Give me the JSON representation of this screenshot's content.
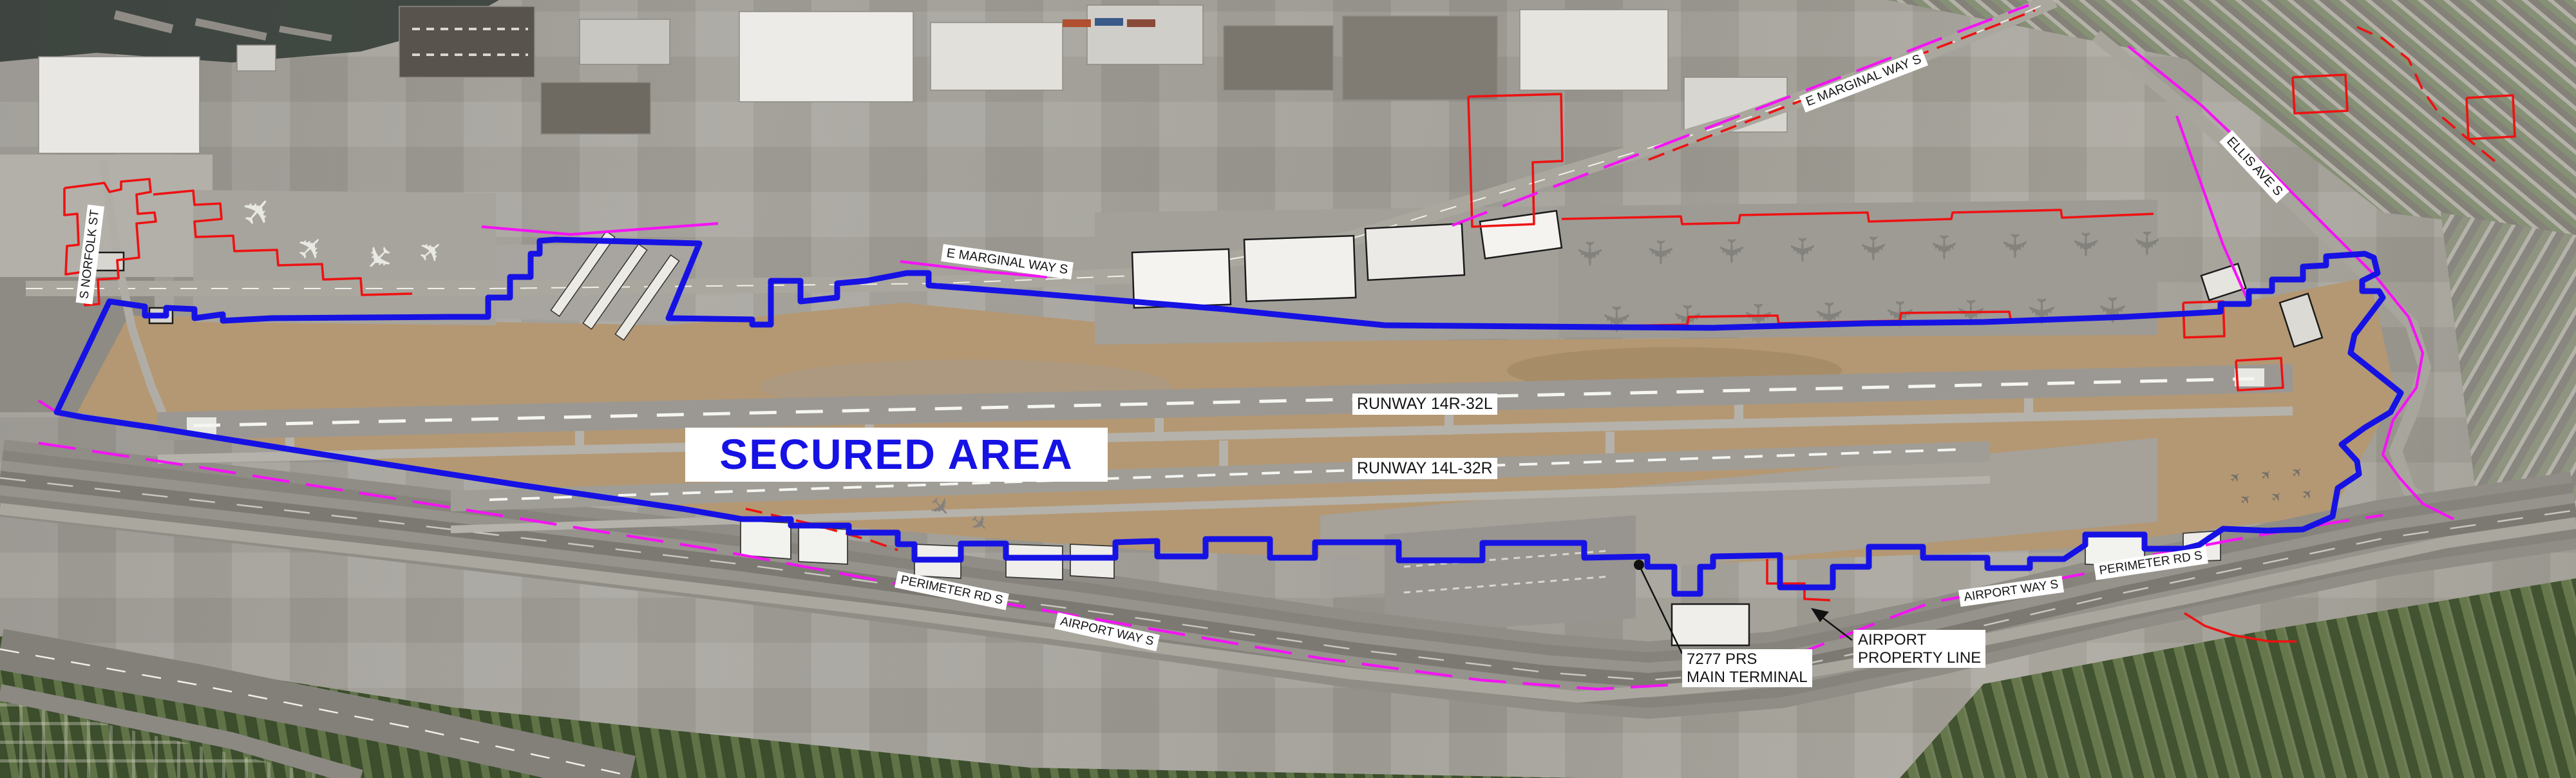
{
  "labels": {
    "secured_area": "SECURED AREA",
    "runway_14r": "RUNWAY 14R-32L",
    "runway_14l": "RUNWAY 14L-32R",
    "e_marginal_west": "E MARGINAL WAY S",
    "e_marginal_east": "E MARGINAL WAY S",
    "ellis_ave": "ELLIS AVE S",
    "s_norfolk": "S NORFOLK ST",
    "perimeter_rd_west": "PERIMETER RD S",
    "airport_way_west": "AIRPORT WAY S",
    "airport_way_east": "AIRPORT WAY S",
    "perimeter_rd_east": "PERIMETER RD S"
  },
  "callouts": {
    "terminal": {
      "line1": "7277 PRS",
      "line2": "MAIN TERMINAL"
    },
    "property": {
      "line1": "AIRPORT",
      "line2": "PROPERTY LINE"
    }
  },
  "colors": {
    "secured_boundary": "#1612e4",
    "secured_text": "#1612e4",
    "lease_lines_red": "#ee1212",
    "property_line_magenta": "#f513f5",
    "label_text": "#151515",
    "label_background": "#ffffff"
  },
  "icons": {
    "airplane": "✈"
  },
  "overlays": {
    "secured_boundary": "88,640 170,468 225,476 225,490 258,490 258,478 302,480 302,494 346,488 346,498 422,494 700,492 758,492 758,462 792,462 792,430 824,430 824,394 838,394 838,374 862,372 1086,378 1038,494 1168,496 1168,504 1197,504 1197,436 1243,436 1243,468 1300,462 1300,440 1345,436 1408,424 1442,424 1442,443 1600,455 1900,480 2150,505 2500,508 2660,509 2900,502 3080,500 3300,492 3448,484 3448,472 3492,472 3492,452 3528,452 3528,434 3576,434 3576,414 3612,412 3612,398 3672,394 3686,400 3692,424 3668,436 3668,452 3694,452 3700,462 3656,520 3650,548 3728,610 3712,640 3672,664 3636,690 3660,716 3663,736 3630,758 3622,802 3576,822 3520,824 3452,821 3415,846 3392,852 3330,852 3330,830 3238,830 3238,846 3205,868 3152,868 3152,882 3086,882 3086,866 2986,866 2986,849 2902,849 2902,880 2846,880 2846,912 2764,912 2764,862 2660,864 2660,880 2640,880 2640,922 2600,922 2600,880 2558,880 2558,864 2460,866 2460,843 2302,843 2302,870 2172,870 2172,842 2042,842 2042,866 1972,866 1972,837 1872,837 1872,864 1797,864 1797,840 1732,842 1732,866 1562,866 1562,844 1492,844 1492,869 1420,869 1420,845 1394,845 1394,827 1318,827 1318,816 1228,816 1228,806 1152,806 1060,790 800,752 452,698 240,664 130,648 88,640",
    "red_lines": [
      "100,292 162,284 170,298 188,294 188,282 232,278 234,298 212,302 214,332 240,330 242,344 212,347 216,400 182,404 184,432 152,434 154,472 132,474 130,422 102,426 104,382 122,380 120,332 100,334 100,292",
      "238,302 300,296 302,318 342,316 344,340 302,344 304,368 362,366 364,390 430,388 432,412 500,410 502,434 560,432 562,458 640,456",
      "2425,340 2610,336 2612,348 2700,346 2702,334 2900,330 2902,344 3030,340 3032,330 3200,326 3202,338 3344,332",
      "2425,508 2620,504 2622,492 2760,490 2762,502 2950,498 2952,486 3120,484 3122,496 3344,490",
      "2280,150 2424,146 2426,250 2380,252 2382,348 2286,352 2280,150",
      "2560,248 2720,186 2880,124 3040,62 3160,16",
      "3390,470 3452,468 3454,522 3392,524 3390,470",
      "3472,560 3542,556 3545,602 3475,606 3472,560",
      "3560,120 3642,116 3645,172 3563,176 3560,120",
      "3660,42 3700,60 3740,92 3762,140 3790,180 3830,214 3876,252",
      "2744,868 2744,906 2802,906 2802,930 2842,932",
      "1158,790 1262,814 1354,840 1394,854",
      "3392,952 3424,972 3466,986 3524,996 3566,996",
      "3830,152 3902,148 3905,212 3833,216 3830,152"
    ],
    "magenta_lines": [
      "60,688 300,724 600,772 900,820 1100,852 1390,906",
      "1452,918 1750,970 2050,1022 2300,1056 2480,1070 2620,1062 2780,1020 2912,968 3000,935 3150,908 3250,888 3340,862 3480,836 3620,812 3700,800",
      "748,352 886,364 1115,347",
      "1398,406 1532,422 1626,430",
      "2255,350 2420,287 2585,224 2750,161 2915,98 3060,42 3150,8",
      "3305,72 3420,165 3525,265 3615,355 3688,428 3740,492 3762,548 3752,602 3716,652 3700,706 3726,742 3762,782 3810,806",
      "3380,180 3416,280 3452,380 3492,470",
      "60,622 82,636 98,646"
    ]
  }
}
